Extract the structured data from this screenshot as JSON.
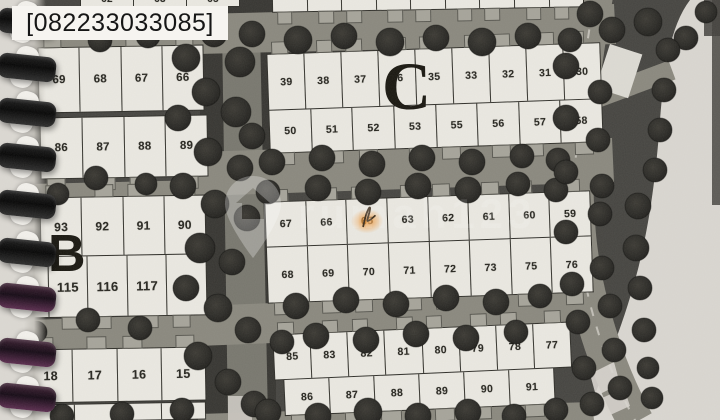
{
  "phone_label": "[082233033085]",
  "watermark": {
    "text": "rumah123",
    "icon": "location-pin-house-icon"
  },
  "blocks": {
    "left": {
      "label": "B",
      "rows": [
        {
          "id": "l-row-0",
          "cells": [
            "62",
            "63",
            "65"
          ]
        },
        {
          "id": "l-row-1",
          "cells": [
            "69",
            "68",
            "67",
            "66"
          ]
        },
        {
          "id": "l-row-2",
          "cells": [
            "86",
            "87",
            "88",
            "89"
          ]
        },
        {
          "id": "l-row-3",
          "cells": [
            "93",
            "92",
            "91",
            "90"
          ]
        },
        {
          "id": "l-row-4",
          "cells": [
            "114",
            "115",
            "116",
            "117",
            "118"
          ]
        },
        {
          "id": "l-row-5",
          "cells": [
            "18",
            "17",
            "16",
            "15"
          ]
        },
        {
          "id": "l-row-6",
          "cells": [
            "",
            "",
            "",
            ""
          ]
        }
      ]
    },
    "c": {
      "label": "C",
      "rows": [
        {
          "id": "c-row-0",
          "cells": [
            "",
            "",
            "",
            "",
            "",
            "",
            "",
            "",
            ""
          ]
        },
        {
          "id": "c-row-1",
          "cells": [
            "39",
            "38",
            "37",
            "36",
            "35",
            "33",
            "32",
            "31",
            "30"
          ]
        },
        {
          "id": "c-row-2",
          "cells": [
            "50",
            "51",
            "52",
            "53",
            "55",
            "56",
            "57",
            "58"
          ]
        },
        {
          "id": "c-row-3",
          "cells": [
            "67",
            "66",
            "65",
            "63",
            "62",
            "61",
            "60",
            "59"
          ],
          "highlighted": "65"
        },
        {
          "id": "c-row-4",
          "cells": [
            "68",
            "69",
            "70",
            "71",
            "72",
            "73",
            "75",
            "76"
          ]
        },
        {
          "id": "c-row-5",
          "cells": [
            "85",
            "83",
            "82",
            "81",
            "80",
            "79",
            "78",
            "77"
          ]
        },
        {
          "id": "c-row-6",
          "cells": [
            "86",
            "87",
            "88",
            "89",
            "90",
            "91"
          ]
        }
      ]
    }
  },
  "colors": {
    "page_background": "#dad7d1",
    "map_dark": "#454440",
    "lot_fill": "#ebe9e2",
    "road": "#8a887e",
    "tree": "#2c2b27",
    "highlight": "#f0983a",
    "binding": "#111111"
  }
}
